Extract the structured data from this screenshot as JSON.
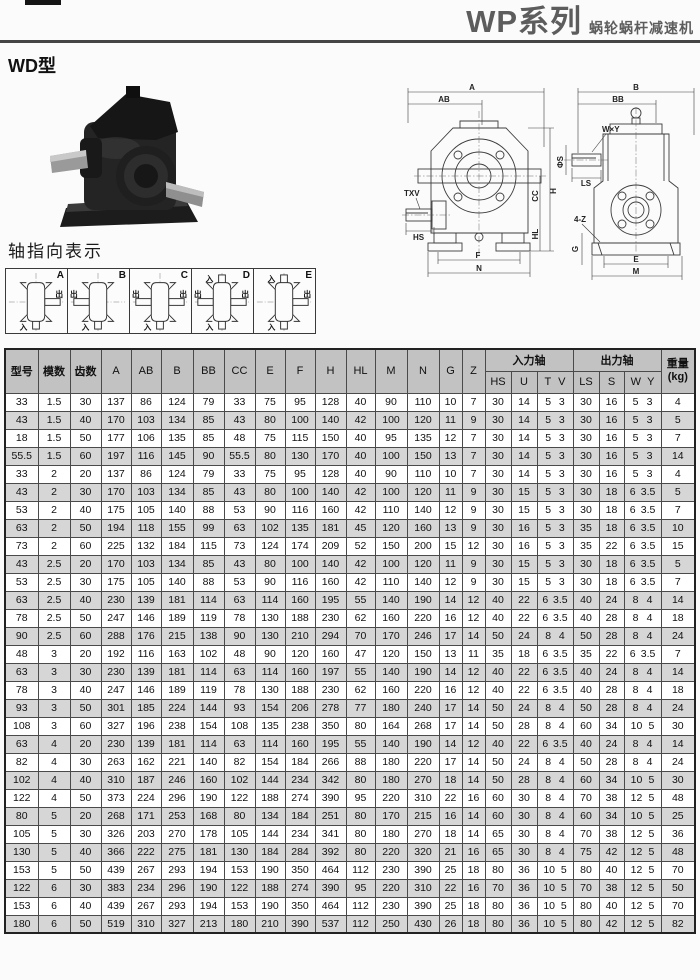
{
  "page": {
    "title_main": "WP系列",
    "title_sub": "蜗轮蜗杆减速机",
    "section_label": "WD型",
    "axis_section_title": "轴指向表示"
  },
  "drawing": {
    "labels": {
      "a": "A",
      "ab": "AB",
      "txv": "TXV",
      "hs": "HS",
      "h": "H",
      "cc": "CC",
      "hl": "HL",
      "f": "F",
      "n": "N",
      "b": "B",
      "bb": "BB",
      "wxy": "W×Y",
      "phis": "ΦS",
      "ls": "LS",
      "fourz": "4-Z",
      "g": "G",
      "e": "E",
      "m": "M"
    }
  },
  "legend": {
    "input": "入",
    "output": "出"
  },
  "axis_diagrams": [
    {
      "label": "A",
      "inputs": [
        "bottom"
      ],
      "outputs": [
        "right"
      ]
    },
    {
      "label": "B",
      "inputs": [
        "bottom"
      ],
      "outputs": [
        "left"
      ]
    },
    {
      "label": "C",
      "inputs": [
        "bottom"
      ],
      "outputs": [
        "left",
        "right"
      ]
    },
    {
      "label": "D",
      "inputs": [
        "top",
        "bottom"
      ],
      "outputs": [
        "left",
        "right"
      ]
    },
    {
      "label": "E",
      "inputs": [
        "top",
        "bottom"
      ],
      "outputs": [
        "right"
      ]
    }
  ],
  "table": {
    "columns": [
      "型号",
      "模数",
      "齿数",
      "A",
      "AB",
      "B",
      "BB",
      "CC",
      "E",
      "F",
      "H",
      "HL",
      "M",
      "N",
      "G",
      "Z"
    ],
    "input_group": "入力轴",
    "output_group": "出力轴",
    "sub_columns": [
      "HS",
      "U",
      "T",
      "V",
      "LS",
      "S",
      "W",
      "Y"
    ],
    "weight_line1": "重量",
    "weight_line2": "(kg)",
    "rows": [
      [
        "33",
        "1.5",
        "30",
        "137",
        "86",
        "124",
        "79",
        "33",
        "75",
        "95",
        "128",
        "40",
        "90",
        "110",
        "10",
        "7",
        "30",
        "14",
        "5",
        "3",
        "30",
        "16",
        "5",
        "3",
        "4"
      ],
      [
        "43",
        "1.5",
        "40",
        "170",
        "103",
        "134",
        "85",
        "43",
        "80",
        "100",
        "140",
        "42",
        "100",
        "120",
        "11",
        "9",
        "30",
        "14",
        "5",
        "3",
        "30",
        "16",
        "5",
        "3",
        "5"
      ],
      [
        "18",
        "1.5",
        "50",
        "177",
        "106",
        "135",
        "85",
        "48",
        "75",
        "115",
        "150",
        "40",
        "95",
        "135",
        "12",
        "7",
        "30",
        "14",
        "5",
        "3",
        "30",
        "16",
        "5",
        "3",
        "7"
      ],
      [
        "55.5",
        "1.5",
        "60",
        "197",
        "116",
        "145",
        "90",
        "55.5",
        "80",
        "130",
        "170",
        "40",
        "100",
        "150",
        "13",
        "7",
        "30",
        "14",
        "5",
        "3",
        "30",
        "16",
        "5",
        "3",
        "14"
      ],
      [
        "33",
        "2",
        "20",
        "137",
        "86",
        "124",
        "79",
        "33",
        "75",
        "95",
        "128",
        "40",
        "90",
        "110",
        "10",
        "7",
        "30",
        "14",
        "5",
        "3",
        "30",
        "16",
        "5",
        "3",
        "4"
      ],
      [
        "43",
        "2",
        "30",
        "170",
        "103",
        "134",
        "85",
        "43",
        "80",
        "100",
        "140",
        "42",
        "100",
        "120",
        "11",
        "9",
        "30",
        "15",
        "5",
        "3",
        "30",
        "18",
        "6",
        "3.5",
        "5"
      ],
      [
        "53",
        "2",
        "40",
        "175",
        "105",
        "140",
        "88",
        "53",
        "90",
        "116",
        "160",
        "42",
        "110",
        "140",
        "12",
        "9",
        "30",
        "15",
        "5",
        "3",
        "30",
        "18",
        "6",
        "3.5",
        "7"
      ],
      [
        "63",
        "2",
        "50",
        "194",
        "118",
        "155",
        "99",
        "63",
        "102",
        "135",
        "181",
        "45",
        "120",
        "160",
        "13",
        "9",
        "30",
        "16",
        "5",
        "3",
        "35",
        "18",
        "6",
        "3.5",
        "10"
      ],
      [
        "73",
        "2",
        "60",
        "225",
        "132",
        "184",
        "115",
        "73",
        "124",
        "174",
        "209",
        "52",
        "150",
        "200",
        "15",
        "12",
        "30",
        "16",
        "5",
        "3",
        "35",
        "22",
        "6",
        "3.5",
        "15"
      ],
      [
        "43",
        "2.5",
        "20",
        "170",
        "103",
        "134",
        "85",
        "43",
        "80",
        "100",
        "140",
        "42",
        "100",
        "120",
        "11",
        "9",
        "30",
        "15",
        "5",
        "3",
        "30",
        "18",
        "6",
        "3.5",
        "5"
      ],
      [
        "53",
        "2.5",
        "30",
        "175",
        "105",
        "140",
        "88",
        "53",
        "90",
        "116",
        "160",
        "42",
        "110",
        "140",
        "12",
        "9",
        "30",
        "15",
        "5",
        "3",
        "30",
        "18",
        "6",
        "3.5",
        "7"
      ],
      [
        "63",
        "2.5",
        "40",
        "230",
        "139",
        "181",
        "114",
        "63",
        "114",
        "160",
        "195",
        "55",
        "140",
        "190",
        "14",
        "12",
        "40",
        "22",
        "6",
        "3.5",
        "40",
        "24",
        "8",
        "4",
        "14"
      ],
      [
        "78",
        "2.5",
        "50",
        "247",
        "146",
        "189",
        "119",
        "78",
        "130",
        "188",
        "230",
        "62",
        "160",
        "220",
        "16",
        "12",
        "40",
        "22",
        "6",
        "3.5",
        "40",
        "28",
        "8",
        "4",
        "18"
      ],
      [
        "90",
        "2.5",
        "60",
        "288",
        "176",
        "215",
        "138",
        "90",
        "130",
        "210",
        "294",
        "70",
        "170",
        "246",
        "17",
        "14",
        "50",
        "24",
        "8",
        "4",
        "50",
        "28",
        "8",
        "4",
        "24"
      ],
      [
        "48",
        "3",
        "20",
        "192",
        "116",
        "163",
        "102",
        "48",
        "90",
        "120",
        "160",
        "47",
        "120",
        "150",
        "13",
        "11",
        "35",
        "18",
        "6",
        "3.5",
        "35",
        "22",
        "6",
        "3.5",
        "7"
      ],
      [
        "63",
        "3",
        "30",
        "230",
        "139",
        "181",
        "114",
        "63",
        "114",
        "160",
        "197",
        "55",
        "140",
        "190",
        "14",
        "12",
        "40",
        "22",
        "6",
        "3.5",
        "40",
        "24",
        "8",
        "4",
        "14"
      ],
      [
        "78",
        "3",
        "40",
        "247",
        "146",
        "189",
        "119",
        "78",
        "130",
        "188",
        "230",
        "62",
        "160",
        "220",
        "16",
        "12",
        "40",
        "22",
        "6",
        "3.5",
        "40",
        "28",
        "8",
        "4",
        "18"
      ],
      [
        "93",
        "3",
        "50",
        "301",
        "185",
        "224",
        "144",
        "93",
        "154",
        "206",
        "278",
        "77",
        "180",
        "240",
        "17",
        "14",
        "50",
        "24",
        "8",
        "4",
        "50",
        "28",
        "8",
        "4",
        "24"
      ],
      [
        "108",
        "3",
        "60",
        "327",
        "196",
        "238",
        "154",
        "108",
        "135",
        "238",
        "350",
        "80",
        "164",
        "268",
        "17",
        "14",
        "50",
        "28",
        "8",
        "4",
        "60",
        "34",
        "10",
        "5",
        "30"
      ],
      [
        "63",
        "4",
        "20",
        "230",
        "139",
        "181",
        "114",
        "63",
        "114",
        "160",
        "195",
        "55",
        "140",
        "190",
        "14",
        "12",
        "40",
        "22",
        "6",
        "3.5",
        "40",
        "24",
        "8",
        "4",
        "14"
      ],
      [
        "82",
        "4",
        "30",
        "263",
        "162",
        "221",
        "140",
        "82",
        "154",
        "184",
        "266",
        "88",
        "180",
        "220",
        "17",
        "14",
        "50",
        "24",
        "8",
        "4",
        "50",
        "28",
        "8",
        "4",
        "24"
      ],
      [
        "102",
        "4",
        "40",
        "310",
        "187",
        "246",
        "160",
        "102",
        "144",
        "234",
        "342",
        "80",
        "180",
        "270",
        "18",
        "14",
        "50",
        "28",
        "8",
        "4",
        "60",
        "34",
        "10",
        "5",
        "30"
      ],
      [
        "122",
        "4",
        "50",
        "373",
        "224",
        "296",
        "190",
        "122",
        "188",
        "274",
        "390",
        "95",
        "220",
        "310",
        "22",
        "16",
        "60",
        "30",
        "8",
        "4",
        "70",
        "38",
        "12",
        "5",
        "48"
      ],
      [
        "80",
        "5",
        "20",
        "268",
        "171",
        "253",
        "168",
        "80",
        "134",
        "184",
        "251",
        "80",
        "170",
        "215",
        "16",
        "14",
        "60",
        "30",
        "8",
        "4",
        "60",
        "34",
        "10",
        "5",
        "25"
      ],
      [
        "105",
        "5",
        "30",
        "326",
        "203",
        "270",
        "178",
        "105",
        "144",
        "234",
        "341",
        "80",
        "180",
        "270",
        "18",
        "14",
        "65",
        "30",
        "8",
        "4",
        "70",
        "38",
        "12",
        "5",
        "36"
      ],
      [
        "130",
        "5",
        "40",
        "366",
        "222",
        "275",
        "181",
        "130",
        "184",
        "284",
        "392",
        "80",
        "220",
        "320",
        "21",
        "16",
        "65",
        "30",
        "8",
        "4",
        "75",
        "42",
        "12",
        "5",
        "48"
      ],
      [
        "153",
        "5",
        "50",
        "439",
        "267",
        "293",
        "194",
        "153",
        "190",
        "350",
        "464",
        "112",
        "230",
        "390",
        "25",
        "18",
        "80",
        "36",
        "10",
        "5",
        "80",
        "40",
        "12",
        "5",
        "70"
      ],
      [
        "122",
        "6",
        "30",
        "383",
        "234",
        "296",
        "190",
        "122",
        "188",
        "274",
        "390",
        "95",
        "220",
        "310",
        "22",
        "16",
        "70",
        "36",
        "10",
        "5",
        "70",
        "38",
        "12",
        "5",
        "50"
      ],
      [
        "153",
        "6",
        "40",
        "439",
        "267",
        "293",
        "194",
        "153",
        "190",
        "350",
        "464",
        "112",
        "230",
        "390",
        "25",
        "18",
        "80",
        "36",
        "10",
        "5",
        "80",
        "40",
        "12",
        "5",
        "70"
      ],
      [
        "180",
        "6",
        "50",
        "519",
        "310",
        "327",
        "213",
        "180",
        "210",
        "390",
        "537",
        "112",
        "250",
        "430",
        "26",
        "18",
        "80",
        "36",
        "10",
        "5",
        "80",
        "42",
        "12",
        "5",
        "82"
      ]
    ]
  }
}
